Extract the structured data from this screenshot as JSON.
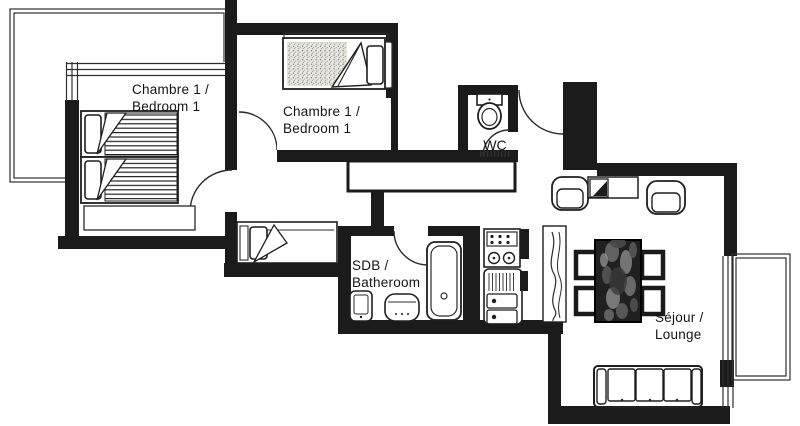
{
  "plan": {
    "rooms": {
      "bedroom_left": {
        "line1": "Chambre 1 /",
        "line2": "Bedroom 1"
      },
      "bedroom_middle": {
        "line1": "Chambre 1 /",
        "line2": "Bedroom 1"
      },
      "wc": {
        "label": "WC"
      },
      "bathroom": {
        "line1": "SDB /",
        "line2": "Batheroom"
      },
      "lounge": {
        "line1": "Séjour /",
        "line2": "Lounge"
      }
    }
  },
  "colors": {
    "wall": "#1b1b1b",
    "line": "#2e2e2e",
    "background": "#ffffff",
    "table_texture": "#202020",
    "mattress_stipple": "#e9e7e2"
  },
  "icons": {
    "twin_beds": "twin-bed",
    "middle_bed": "single-bed",
    "alcove_bed": "single-bed",
    "toilet": "toilet",
    "bathtub": "bathtub",
    "washbasin": "washbasin",
    "radiator": "radiator",
    "kitchen_hob": "kitchen-hob",
    "kitchen_sink": "kitchen-sink",
    "dining_table": "dining-table",
    "dining_chair": "dining-chair",
    "armchair": "armchair",
    "sofa": "sofa",
    "tv_unit": "tv-unit",
    "closet": "hallway-closet",
    "curtain": "curtain-panel",
    "door": "door-swing",
    "window": "window",
    "balcony": "balcony"
  }
}
